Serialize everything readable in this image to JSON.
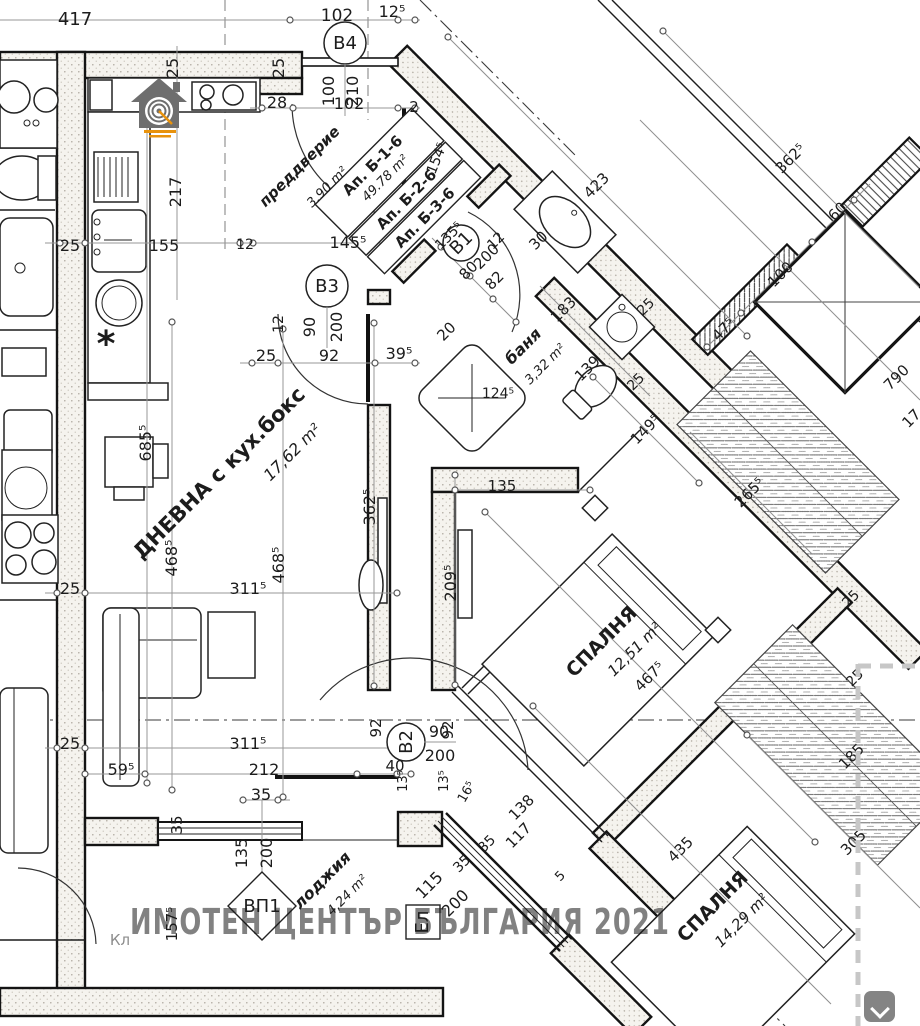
{
  "watermark": {
    "text": "ИМОТЕН ЦЕНТЪР БЪЛГАРИЯ 2021",
    "color": "#c4595c"
  },
  "tags": {
    "b4": {
      "id": "B4",
      "w": "100",
      "h": "210"
    },
    "b3": {
      "id": "B3",
      "w": "90",
      "h": "200"
    },
    "b2": {
      "id": "B2",
      "w": "90",
      "h": "200"
    },
    "b1": {
      "id": "B1"
    },
    "vp1": {
      "id": "ВП1",
      "w": "135",
      "h": "200"
    },
    "el": {
      "id": "Ел"
    }
  },
  "apartment_box": {
    "ap1": "Ап. Б-1-6",
    "area": "49.78 m²",
    "ap2": "Ап. Б-2-6",
    "ap3": "Ап. Б-3-6"
  },
  "icons": {
    "scroll_button": "chevron-down-icon",
    "logo": "house-target-logo"
  },
  "colors": {
    "watermark": "#c4595c",
    "logo_gray": "#6e6e6e",
    "logo_orange": "#e8920c",
    "crop_dash": "#c7c7c7"
  },
  "rooms": {
    "living": {
      "name": "ДНЕВНА с кух.бокс",
      "area": "17,62 m²"
    },
    "entry": {
      "name": "преддверие",
      "area": "3.90 m²"
    },
    "bath": {
      "name": "баня",
      "area": "3,32 m²"
    },
    "bedroom1": {
      "name": "СПАЛНЯ",
      "area": "12,51 m²"
    },
    "bedroom2": {
      "name": "СПАЛНЯ",
      "area": "14,29 m²"
    },
    "loggia": {
      "name": "лоджия",
      "area": "4,24 m²"
    }
  },
  "dims": [
    {
      "t": "417",
      "x": 75,
      "y": 25,
      "s": 18
    },
    {
      "t": "102",
      "x": 337,
      "y": 21,
      "s": 17
    },
    {
      "t": "12⁵",
      "x": 392,
      "y": 17,
      "s": 16
    },
    {
      "t": "25",
      "x": 178,
      "y": 68,
      "r": -90,
      "s": 16
    },
    {
      "t": "25",
      "x": 284,
      "y": 68,
      "r": -90,
      "s": 16
    },
    {
      "t": "28",
      "x": 277,
      "y": 108,
      "s": 16
    },
    {
      "t": "102",
      "x": 349,
      "y": 109,
      "s": 16
    },
    {
      "t": "2",
      "x": 414,
      "y": 112,
      "s": 15
    },
    {
      "t": "154⁵",
      "x": 441,
      "y": 160,
      "r": -68,
      "s": 14
    },
    {
      "t": "217",
      "x": 181,
      "y": 192,
      "r": -90,
      "s": 16
    },
    {
      "t": "25",
      "x": 70,
      "y": 251,
      "s": 16
    },
    {
      "t": "155",
      "x": 164,
      "y": 251,
      "s": 16
    },
    {
      "t": "12",
      "x": 245,
      "y": 249,
      "s": 14
    },
    {
      "t": "145⁵",
      "x": 348,
      "y": 248,
      "s": 16
    },
    {
      "t": "135⁵",
      "x": 452,
      "y": 239,
      "r": -45,
      "s": 14
    },
    {
      "t": "12",
      "x": 499,
      "y": 244,
      "r": -45,
      "s": 14
    },
    {
      "t": "30",
      "x": 542,
      "y": 244,
      "r": -45,
      "s": 15
    },
    {
      "t": "200",
      "x": 490,
      "y": 260,
      "r": -45,
      "s": 15,
      "n": "door-b1-height"
    },
    {
      "t": "80",
      "x": 472,
      "y": 274,
      "r": -45,
      "s": 15,
      "n": "door-b1-width"
    },
    {
      "t": "82",
      "x": 498,
      "y": 284,
      "r": -45,
      "s": 15
    },
    {
      "t": "20",
      "x": 450,
      "y": 335,
      "r": -45,
      "s": 15
    },
    {
      "t": "183",
      "x": 567,
      "y": 313,
      "r": -45,
      "s": 15
    },
    {
      "t": "25",
      "x": 649,
      "y": 310,
      "r": -45,
      "s": 14
    },
    {
      "t": "139",
      "x": 591,
      "y": 372,
      "r": -45,
      "s": 15
    },
    {
      "t": "25",
      "x": 639,
      "y": 385,
      "r": -45,
      "s": 14
    },
    {
      "t": "149⁵",
      "x": 649,
      "y": 433,
      "r": -45,
      "s": 15
    },
    {
      "t": "47⁵",
      "x": 727,
      "y": 333,
      "r": -45,
      "s": 15
    },
    {
      "t": "100",
      "x": 784,
      "y": 278,
      "r": -45,
      "s": 15
    },
    {
      "t": "60",
      "x": 841,
      "y": 215,
      "r": -45,
      "s": 15
    },
    {
      "t": "423",
      "x": 600,
      "y": 189,
      "r": -45,
      "s": 15
    },
    {
      "t": "362⁵",
      "x": 794,
      "y": 162,
      "r": -45,
      "s": 15
    },
    {
      "t": "790",
      "x": 900,
      "y": 381,
      "r": -45,
      "s": 15
    },
    {
      "t": "17",
      "x": 915,
      "y": 422,
      "r": -45,
      "s": 15
    },
    {
      "t": "25",
      "x": 266,
      "y": 361,
      "s": 16
    },
    {
      "t": "92",
      "x": 329,
      "y": 361,
      "s": 16
    },
    {
      "t": "39⁵",
      "x": 399,
      "y": 359,
      "s": 16
    },
    {
      "t": "12",
      "x": 283,
      "y": 324,
      "r": -90,
      "s": 14
    },
    {
      "t": "124⁵",
      "x": 498,
      "y": 398,
      "s": 14
    },
    {
      "t": "135",
      "x": 502,
      "y": 491,
      "s": 15
    },
    {
      "t": "685⁵",
      "x": 151,
      "y": 443,
      "r": -90,
      "s": 16
    },
    {
      "t": "468⁵",
      "x": 177,
      "y": 558,
      "r": -90,
      "s": 16
    },
    {
      "t": "468⁵",
      "x": 284,
      "y": 565,
      "r": -90,
      "s": 16
    },
    {
      "t": "362⁵",
      "x": 375,
      "y": 507,
      "r": -90,
      "s": 16
    },
    {
      "t": "209⁵",
      "x": 456,
      "y": 583,
      "r": -90,
      "s": 16
    },
    {
      "t": "311⁵",
      "x": 248,
      "y": 594,
      "s": 16
    },
    {
      "t": "25",
      "x": 70,
      "y": 594,
      "s": 16
    },
    {
      "t": "311⁵",
      "x": 248,
      "y": 749,
      "s": 16
    },
    {
      "t": "25",
      "x": 70,
      "y": 749,
      "s": 16
    },
    {
      "t": "59⁵",
      "x": 121,
      "y": 775,
      "s": 16
    },
    {
      "t": "212",
      "x": 264,
      "y": 775,
      "s": 16
    },
    {
      "t": "35",
      "x": 261,
      "y": 800,
      "s": 16
    },
    {
      "t": "40",
      "x": 395,
      "y": 771,
      "s": 15
    },
    {
      "t": "92",
      "x": 381,
      "y": 728,
      "r": -90,
      "s": 15
    },
    {
      "t": "92",
      "x": 453,
      "y": 730,
      "r": -90,
      "s": 15
    },
    {
      "t": "13⁵",
      "x": 407,
      "y": 781,
      "r": -90,
      "s": 13
    },
    {
      "t": "13⁵",
      "x": 448,
      "y": 781,
      "r": -90,
      "s": 13
    },
    {
      "t": "16⁵",
      "x": 470,
      "y": 794,
      "r": -60,
      "s": 13
    },
    {
      "t": "138",
      "x": 525,
      "y": 811,
      "r": -45,
      "s": 15
    },
    {
      "t": "117",
      "x": 522,
      "y": 839,
      "r": -45,
      "s": 15
    },
    {
      "t": "35",
      "x": 490,
      "y": 847,
      "r": -45,
      "s": 14
    },
    {
      "t": "35",
      "x": 465,
      "y": 867,
      "r": -45,
      "s": 14
    },
    {
      "t": "5",
      "x": 563,
      "y": 879,
      "r": -45,
      "s": 13
    },
    {
      "t": "115",
      "x": 433,
      "y": 889,
      "r": -45,
      "s": 16,
      "n": "loggia-window-width"
    },
    {
      "t": "200",
      "x": 459,
      "y": 907,
      "r": -45,
      "s": 16,
      "n": "loggia-window-height"
    },
    {
      "t": "35",
      "x": 182,
      "y": 825,
      "r": -90,
      "s": 15
    },
    {
      "t": "135",
      "x": 247,
      "y": 853,
      "r": -90,
      "s": 16,
      "n": "window-vp1-width"
    },
    {
      "t": "200",
      "x": 272,
      "y": 853,
      "r": -90,
      "s": 16,
      "n": "window-vp1-height"
    },
    {
      "t": "157⁵",
      "x": 177,
      "y": 924,
      "r": -90,
      "s": 15
    },
    {
      "t": "467⁵",
      "x": 653,
      "y": 680,
      "r": -45,
      "s": 15
    },
    {
      "t": "265⁵",
      "x": 753,
      "y": 496,
      "r": -45,
      "s": 15
    },
    {
      "t": "25",
      "x": 854,
      "y": 602,
      "r": -45,
      "s": 14
    },
    {
      "t": "25",
      "x": 858,
      "y": 681,
      "r": -45,
      "s": 14
    },
    {
      "t": "185",
      "x": 855,
      "y": 760,
      "r": -45,
      "s": 15
    },
    {
      "t": "305",
      "x": 857,
      "y": 846,
      "r": -45,
      "s": 15
    },
    {
      "t": "435",
      "x": 684,
      "y": 853,
      "r": -45,
      "s": 15
    },
    {
      "t": "Кл",
      "x": 120,
      "y": 945,
      "s": 15,
      "c": "g",
      "n": "kl-label"
    },
    {
      "t": "*",
      "x": 106,
      "y": 356,
      "s": 36,
      "b": 1,
      "n": "asterisk-mark"
    },
    {
      "t": "ДНЕВНА с кух.бокс",
      "x": 224,
      "y": 478,
      "r": -45,
      "s": 21,
      "b": 1,
      "n": "room-label-living"
    },
    {
      "t": "17,62 m²",
      "x": 296,
      "y": 456,
      "r": -45,
      "s": 16,
      "i": 1,
      "n": "room-area-living"
    },
    {
      "t": "преддверие",
      "x": 303,
      "y": 170,
      "r": -45,
      "s": 15,
      "b": 1,
      "i": 1,
      "n": "room-label-entry"
    },
    {
      "t": "3.90 m²",
      "x": 330,
      "y": 190,
      "r": -45,
      "s": 13,
      "i": 1,
      "n": "room-area-entry"
    },
    {
      "t": "баня",
      "x": 527,
      "y": 350,
      "r": -45,
      "s": 16,
      "b": 1,
      "i": 1,
      "n": "room-label-bath"
    },
    {
      "t": "3,32 m²",
      "x": 548,
      "y": 367,
      "r": -45,
      "s": 13,
      "i": 1,
      "n": "room-area-bath"
    },
    {
      "t": "СПАЛНЯ",
      "x": 606,
      "y": 646,
      "r": -45,
      "s": 19,
      "b": 1,
      "n": "room-label-bedroom-1"
    },
    {
      "t": "12,51 m²",
      "x": 638,
      "y": 653,
      "r": -45,
      "s": 15,
      "i": 1,
      "n": "room-area-bedroom-1"
    },
    {
      "t": "СПАЛНЯ",
      "x": 717,
      "y": 911,
      "r": -45,
      "s": 19,
      "b": 1,
      "n": "room-label-bedroom-2"
    },
    {
      "t": "14,29 m²",
      "x": 745,
      "y": 924,
      "r": -45,
      "s": 15,
      "i": 1,
      "n": "room-area-bedroom-2"
    },
    {
      "t": "лоджия",
      "x": 326,
      "y": 884,
      "r": -45,
      "s": 16,
      "b": 1,
      "i": 1,
      "n": "room-label-loggia"
    },
    {
      "t": "4,24 m²",
      "x": 350,
      "y": 898,
      "r": -45,
      "s": 13,
      "i": 1,
      "n": "room-area-loggia"
    }
  ]
}
